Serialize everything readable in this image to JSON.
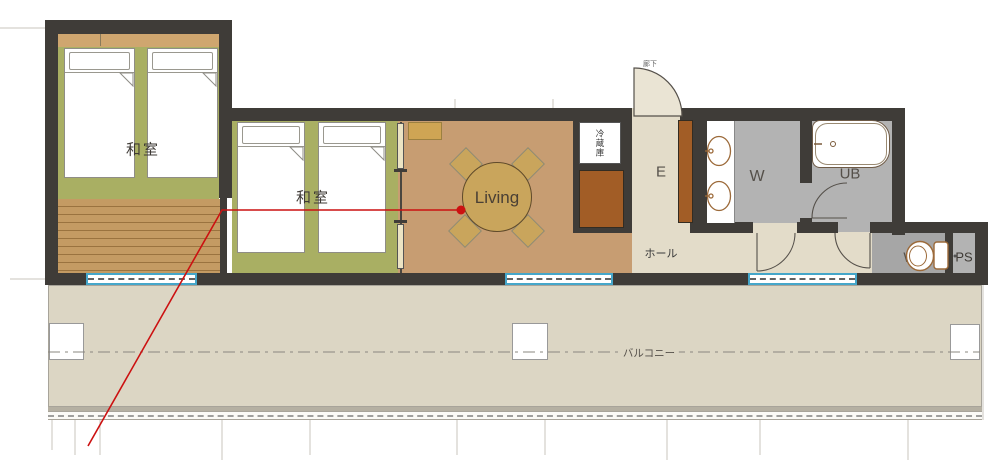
{
  "app": {
    "type": "architectural-floor-plan",
    "description": "Japanese apartment floor plan with two tatami bedrooms, living-dining room, entrance, washroom, unit bath, WC and a long balcony"
  },
  "labels": {
    "washitsu_1": "和室",
    "washitsu_2": "和室",
    "living": "Living",
    "refrigerator": "冷蔵庫",
    "entrance": "E",
    "hall": "ホール",
    "washroom": "W",
    "unit_bath": "UB",
    "wc": "WC",
    "pipe_space": "PS",
    "balcony": "バルコニー",
    "corridor": "廊下"
  },
  "colors": {
    "wall": "#3f3c38",
    "tatami": "#a9af63",
    "wood": "#c79d72",
    "deck": "#c49b63",
    "beige": "#e3dcc9",
    "balcony": "#dcd6c4",
    "gray-wet": "#b3b3b3",
    "gray-wc": "#a6a6a6",
    "brown": "#a25d26",
    "tan": "#c9a55c",
    "accent-tan": "#cfa66f",
    "window-blue": "#45a6c9",
    "red": "#cc1111",
    "guide": "#c9c5bd"
  }
}
